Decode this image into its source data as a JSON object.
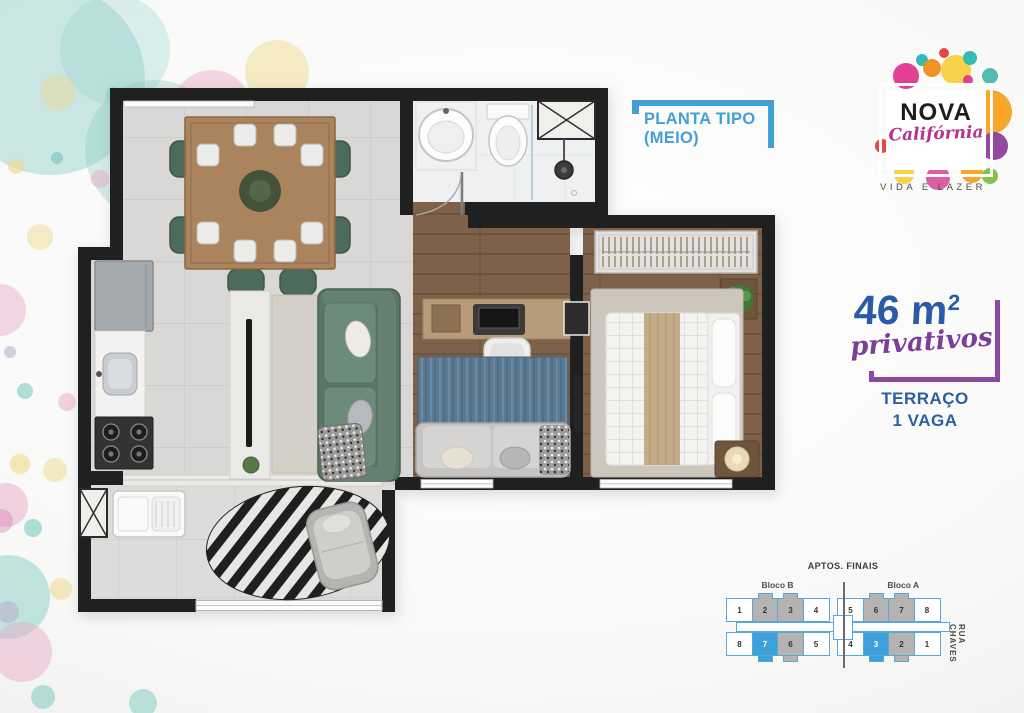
{
  "page": {
    "background": "#f6f6f5"
  },
  "plan_label": {
    "line1": "PLANTA TIPO",
    "line2": "(MEIO)",
    "color": "#43a0d6"
  },
  "logo": {
    "name": "NOVA",
    "script": "Califórnia",
    "tagline": "VIDA E LAZER",
    "bubbles": [
      {
        "x": 40,
        "y": 30,
        "r": 13,
        "c": "#e2368f"
      },
      {
        "x": 56,
        "y": 14,
        "r": 6,
        "c": "#2ab7ae"
      },
      {
        "x": 66,
        "y": 22,
        "r": 9,
        "c": "#f08c1e"
      },
      {
        "x": 90,
        "y": 24,
        "r": 15,
        "c": "#f7cf3e"
      },
      {
        "x": 78,
        "y": 7,
        "r": 5,
        "c": "#e2403a"
      },
      {
        "x": 104,
        "y": 12,
        "r": 7,
        "c": "#2ab7ae"
      },
      {
        "x": 102,
        "y": 34,
        "r": 5,
        "c": "#e2368f"
      },
      {
        "x": 124,
        "y": 30,
        "r": 8,
        "c": "#49b8b0"
      },
      {
        "x": 124,
        "y": 66,
        "r": 22,
        "c": "#f6a21f"
      },
      {
        "x": 128,
        "y": 100,
        "r": 14,
        "c": "#8d3f98"
      },
      {
        "x": 106,
        "y": 126,
        "r": 11,
        "c": "#f6a21f"
      },
      {
        "x": 72,
        "y": 132,
        "r": 12,
        "c": "#d8569f"
      },
      {
        "x": 38,
        "y": 128,
        "r": 10,
        "c": "#f7cf3e"
      },
      {
        "x": 16,
        "y": 100,
        "r": 7,
        "c": "#e2403a"
      },
      {
        "x": 124,
        "y": 130,
        "r": 8,
        "c": "#7ac143"
      }
    ]
  },
  "area": {
    "value": "46 m",
    "sup": "2",
    "script": "privativos",
    "number_color": "#2b5aa7",
    "script_color": "#7b3f98"
  },
  "terrace": {
    "line1": "TERRAÇO",
    "line2": "1 VAGA",
    "color": "#2c5f9f"
  },
  "keyplan": {
    "title": "APTOS. FINAIS",
    "bloco_left": "Bloco B",
    "bloco_right": "Bloco A",
    "street": "RUA CHAVES",
    "colors": {
      "outline": "#58a8d7",
      "gray": "#b4b3b2",
      "blue": "#3f9fda"
    },
    "rows": [
      [
        {
          "n": "1",
          "s": "plain"
        },
        {
          "n": "2",
          "s": "gray"
        },
        {
          "n": "3",
          "s": "gray"
        },
        {
          "n": "4",
          "s": "plain"
        },
        {
          "n": "5",
          "s": "plain"
        },
        {
          "n": "6",
          "s": "gray"
        },
        {
          "n": "7",
          "s": "gray"
        },
        {
          "n": "8",
          "s": "plain"
        }
      ],
      [
        {
          "n": "8",
          "s": "plain"
        },
        {
          "n": "7",
          "s": "blue"
        },
        {
          "n": "6",
          "s": "gray"
        },
        {
          "n": "5",
          "s": "plain"
        },
        {
          "n": "4",
          "s": "plain"
        },
        {
          "n": "3",
          "s": "blue"
        },
        {
          "n": "2",
          "s": "gray"
        },
        {
          "n": "1",
          "s": "plain"
        }
      ]
    ]
  },
  "decor_bubbles": [
    {
      "x": 50,
      "y": 80,
      "r": 95,
      "c": "#7fc9c0",
      "o": 0.38
    },
    {
      "x": 155,
      "y": 150,
      "r": 70,
      "c": "#7fc9c0",
      "o": 0.3
    },
    {
      "x": 115,
      "y": 50,
      "r": 55,
      "c": "#8ed2c9",
      "o": 0.3
    },
    {
      "x": 212,
      "y": 110,
      "r": 40,
      "c": "#e9a8c6",
      "o": 0.45
    },
    {
      "x": 277,
      "y": 72,
      "r": 32,
      "c": "#eed98e",
      "o": 0.5
    },
    {
      "x": 58,
      "y": 92,
      "r": 18,
      "c": "#eed98e",
      "o": 0.45
    },
    {
      "x": 113,
      "y": 94,
      "r": 7,
      "c": "#8fd4c8",
      "o": 0.8
    },
    {
      "x": 57,
      "y": 158,
      "r": 6,
      "c": "#7fc9c0",
      "o": 0.7
    },
    {
      "x": 16,
      "y": 166,
      "r": 8,
      "c": "#eed98e",
      "o": 0.6
    },
    {
      "x": 100,
      "y": 179,
      "r": 9,
      "c": "#e9a8c6",
      "o": 0.5
    },
    {
      "x": 175,
      "y": 222,
      "r": 13,
      "c": "#7fc9c0",
      "o": 0.45
    },
    {
      "x": 40,
      "y": 237,
      "r": 13,
      "c": "#eed98e",
      "o": 0.5
    },
    {
      "x": 0,
      "y": 310,
      "r": 26,
      "c": "#e9a8c6",
      "o": 0.45
    },
    {
      "x": 133,
      "y": 311,
      "r": 8,
      "c": "#e9a8c6",
      "o": 0.55
    },
    {
      "x": 10,
      "y": 352,
      "r": 6,
      "c": "#b39bc8",
      "o": 0.5
    },
    {
      "x": 25,
      "y": 391,
      "r": 8,
      "c": "#7fc9c0",
      "o": 0.6
    },
    {
      "x": 67,
      "y": 402,
      "r": 9,
      "c": "#e9a8c6",
      "o": 0.5
    },
    {
      "x": 20,
      "y": 464,
      "r": 10,
      "c": "#eed98e",
      "o": 0.6
    },
    {
      "x": 55,
      "y": 470,
      "r": 12,
      "c": "#eed98e",
      "o": 0.5
    },
    {
      "x": 6,
      "y": 505,
      "r": 22,
      "c": "#e9a8c6",
      "o": 0.5
    },
    {
      "x": 1,
      "y": 521,
      "r": 12,
      "c": "#dd8ab5",
      "o": 0.45
    },
    {
      "x": 33,
      "y": 528,
      "r": 9,
      "c": "#7fc9c0",
      "o": 0.6
    },
    {
      "x": 8,
      "y": 597,
      "r": 42,
      "c": "#7fc9c0",
      "o": 0.45
    },
    {
      "x": 61,
      "y": 589,
      "r": 11,
      "c": "#eed98e",
      "o": 0.55
    },
    {
      "x": 22,
      "y": 652,
      "r": 30,
      "c": "#e9a8c6",
      "o": 0.45
    },
    {
      "x": 8,
      "y": 612,
      "r": 11,
      "c": "#b39bc8",
      "o": 0.4
    },
    {
      "x": 43,
      "y": 697,
      "r": 12,
      "c": "#7fc9c0",
      "o": 0.55
    },
    {
      "x": 143,
      "y": 703,
      "r": 14,
      "c": "#7fc9c0",
      "o": 0.5
    }
  ]
}
